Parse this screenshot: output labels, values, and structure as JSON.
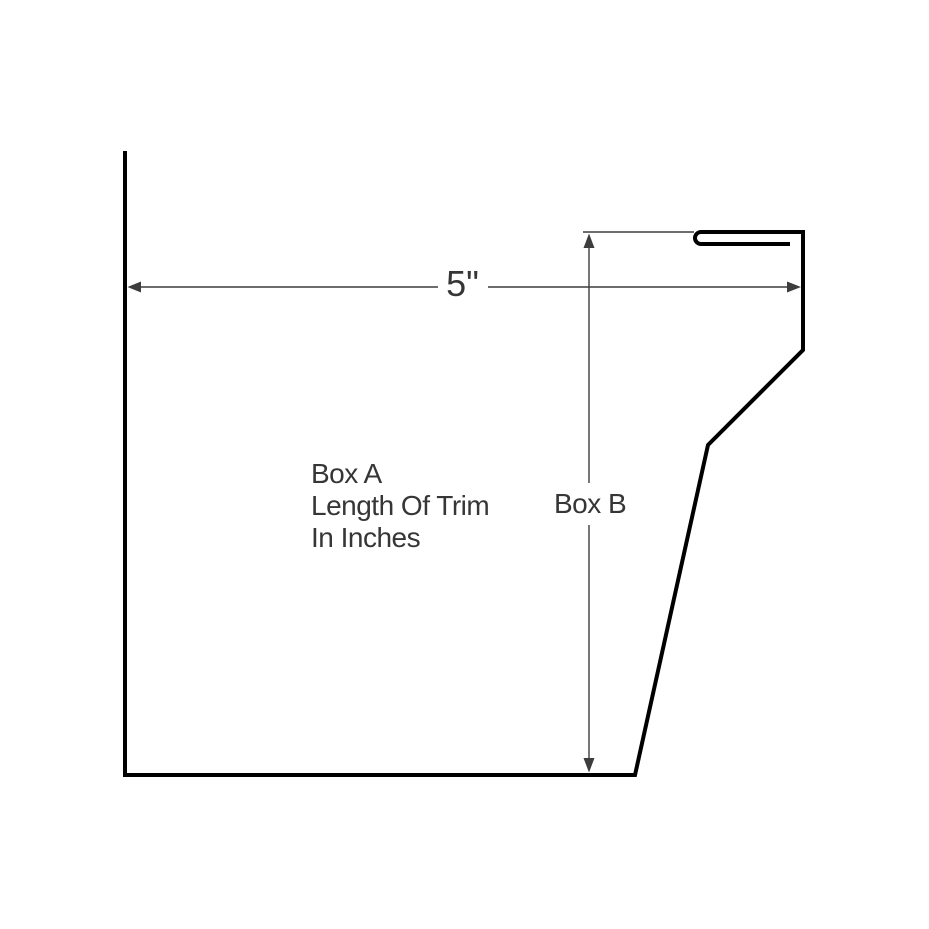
{
  "canvas": {
    "width": 929,
    "height": 929,
    "background": "#ffffff"
  },
  "colors": {
    "profile": "#000000",
    "dimension": "#3d3d3d",
    "text": "#363636"
  },
  "labels": {
    "width_dimension": "5\"",
    "area_line1": "Box A",
    "area_line2": "Length Of Trim",
    "area_line3": "In Inches",
    "height_dimension": "Box B"
  },
  "geometry": {
    "profile_stroke_width": 4,
    "dimension_stroke_width": 1.4,
    "profile_path": "M 125,151 L 125,775 L 635,775 L 708,445 L 803,350 L 803,232 L 701,232 A 6 6 0 0 0 701,244 L 790,244",
    "dimension_lines": [
      {
        "name": "width-dim-line-left",
        "x1": 131,
        "y1": 287,
        "x2": 438,
        "y2": 287
      },
      {
        "name": "width-dim-line-right",
        "x1": 488,
        "y1": 287,
        "x2": 795,
        "y2": 287
      },
      {
        "name": "height-dim-line-upper",
        "x1": 589,
        "y1": 240,
        "x2": 589,
        "y2": 483
      },
      {
        "name": "height-dim-line-lower",
        "x1": 589,
        "y1": 525,
        "x2": 589,
        "y2": 765
      },
      {
        "name": "top-extension-line",
        "x1": 583,
        "y1": 232,
        "x2": 694,
        "y2": 232
      }
    ],
    "arrowheads": [
      {
        "name": "arrowhead-left-icon",
        "points": "127.5,287 141,281.5 141,292.5"
      },
      {
        "name": "arrowhead-right-icon",
        "points": "801,287 787,281.5 787,292.5"
      },
      {
        "name": "arrowhead-up-icon",
        "points": "589,233.5 583.5,248 594.5,248"
      },
      {
        "name": "arrowhead-down-icon",
        "points": "589,772.5 583.5,758 594.5,758"
      }
    ]
  }
}
